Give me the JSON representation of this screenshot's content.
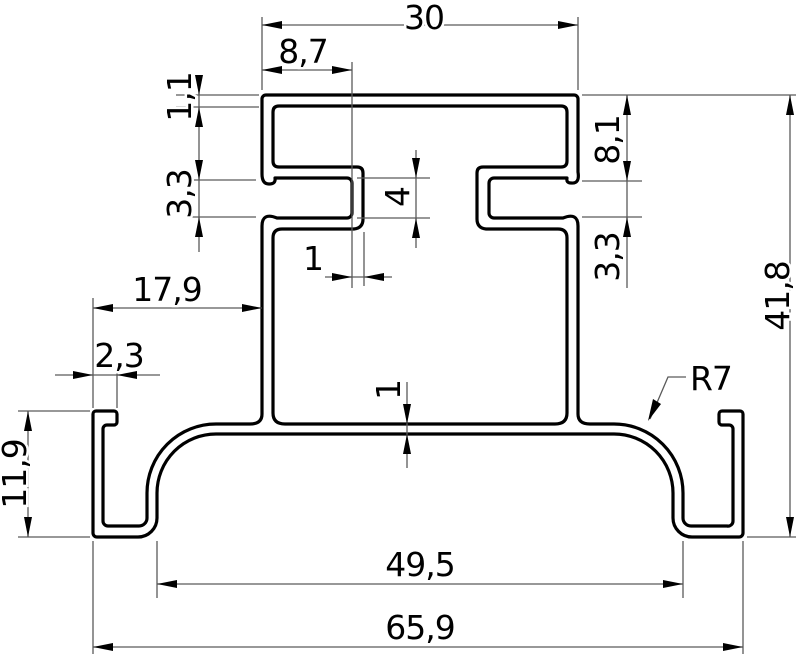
{
  "drawing": {
    "kind": "dimensioned 2D CAD cross-section of an aluminium mounting-rail extrusion profile",
    "background_color": "#ffffff",
    "profile_line_color": "#000000",
    "thin_line_color": "#5a5a5a",
    "decimal_separator": ",",
    "radius_annotation": {
      "label": "R7",
      "value": 7,
      "applies_to": "large corner radius between bottom flange and side drop"
    },
    "dimensions": {
      "top_width": {
        "label": "30",
        "value": 30,
        "orientation": "horizontal",
        "measures": "overall width of top box section"
      },
      "slot_depth": {
        "label": "8,7",
        "value": 8.7,
        "orientation": "horizontal",
        "measures": "left edge to slot end wall"
      },
      "top_wall_thickness": {
        "label": "1,1",
        "value": 1.1,
        "orientation": "vertical",
        "measures": "top wall thickness"
      },
      "slot_opening_left": {
        "label": "3,3",
        "value": 3.3,
        "orientation": "vertical",
        "measures": "left side slot opening height"
      },
      "slot_inner_height": {
        "label": "4",
        "value": 4,
        "orientation": "vertical",
        "measures": "inner height of side slot"
      },
      "slot_end_wall": {
        "label": "1",
        "value": 1,
        "orientation": "horizontal",
        "measures": "slot end wall thickness"
      },
      "head_side_height": {
        "label": "8,1",
        "value": 8.1,
        "orientation": "vertical",
        "measures": "top edge to slot opening, right side"
      },
      "slot_opening_right": {
        "label": "3,3",
        "value": 3.3,
        "orientation": "vertical",
        "measures": "right side slot opening height"
      },
      "total_height": {
        "label": "41,8",
        "value": 41.8,
        "orientation": "vertical",
        "measures": "overall profile height"
      },
      "flange_overhang": {
        "label": "17,9",
        "value": 17.9,
        "orientation": "horizontal",
        "measures": "hook outer edge to body wall"
      },
      "hook_lip_width": {
        "label": "2,3",
        "value": 2.3,
        "orientation": "horizontal",
        "measures": "hook lip width"
      },
      "hook_height": {
        "label": "11,9",
        "value": 11.9,
        "orientation": "vertical",
        "measures": "hook height"
      },
      "flange_thickness": {
        "label": "1",
        "value": 1,
        "orientation": "vertical",
        "measures": "bottom flange thickness"
      },
      "base_span": {
        "label": "49,5",
        "value": 49.5,
        "orientation": "horizontal",
        "measures": "span between bottom drops"
      },
      "total_width": {
        "label": "65,9",
        "value": 65.9,
        "orientation": "horizontal",
        "measures": "overall profile width"
      }
    }
  }
}
